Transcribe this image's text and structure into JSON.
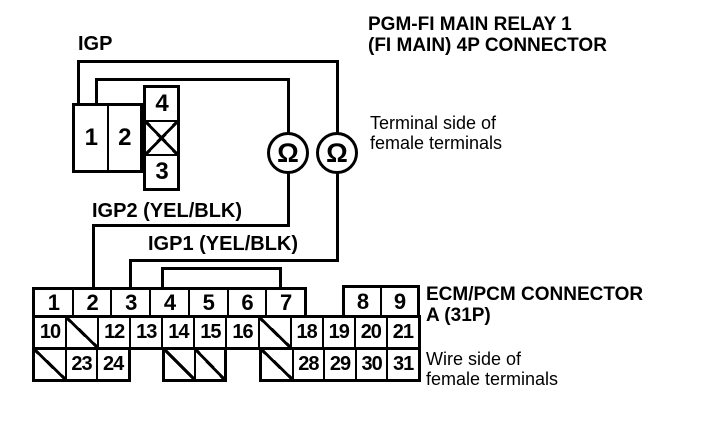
{
  "diagram": {
    "wire_top_label": "IGP",
    "wire_label_igp2": "IGP2 (YEL/BLK)",
    "wire_label_igp1": "IGP1 (YEL/BLK)",
    "ohm_symbol": "Ω",
    "relay_heading": [
      "PGM-FI MAIN RELAY 1",
      "(FI MAIN) 4P CONNECTOR"
    ],
    "relay_note": [
      "Terminal side of",
      "female terminals"
    ],
    "ecm_heading": [
      "ECM/PCM CONNECTOR",
      "A (31P)"
    ],
    "ecm_note": [
      "Wire side of",
      "female terminals"
    ],
    "relay_connector": {
      "left_cells": [
        "1",
        "2"
      ],
      "right_cells": [
        "4",
        "X",
        "3"
      ]
    },
    "ecm_connector": {
      "row1_left": [
        "1",
        "2",
        "3",
        "4",
        "5",
        "6",
        "7"
      ],
      "row1_right": [
        "8",
        "9"
      ],
      "row2": [
        "10",
        "/",
        "12",
        "13",
        "14",
        "15",
        "16",
        "/",
        "18",
        "19",
        "20",
        "21"
      ],
      "row3_left": [
        "/",
        "23",
        "24"
      ],
      "row3_mid": [
        "/",
        "/"
      ],
      "row3_right": [
        "/",
        "28",
        "29",
        "30",
        "31"
      ]
    }
  }
}
